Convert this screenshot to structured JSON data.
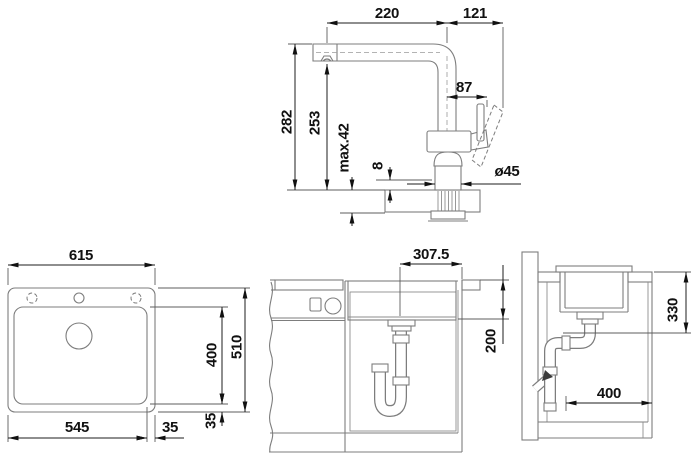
{
  "drawing": {
    "title": "sink-and-faucet-installation-drawing",
    "faucet": {
      "spout_reach": "220",
      "handle_overhang": "121",
      "handle_offset": "87",
      "total_height": "282",
      "spout_height": "253",
      "max_counter": "max.42",
      "base_plate": "8",
      "base_diameter": "ø45"
    },
    "sink_top": {
      "overall_width": "615",
      "overall_depth": "510",
      "bowl_width": "545",
      "bowl_depth": "400",
      "right_offset": "35",
      "bottom_offset": "35"
    },
    "front": {
      "drain_offset": "307.5",
      "drain_height": "200"
    },
    "side": {
      "drain_depth": "330",
      "interior_clearance": "400"
    }
  }
}
